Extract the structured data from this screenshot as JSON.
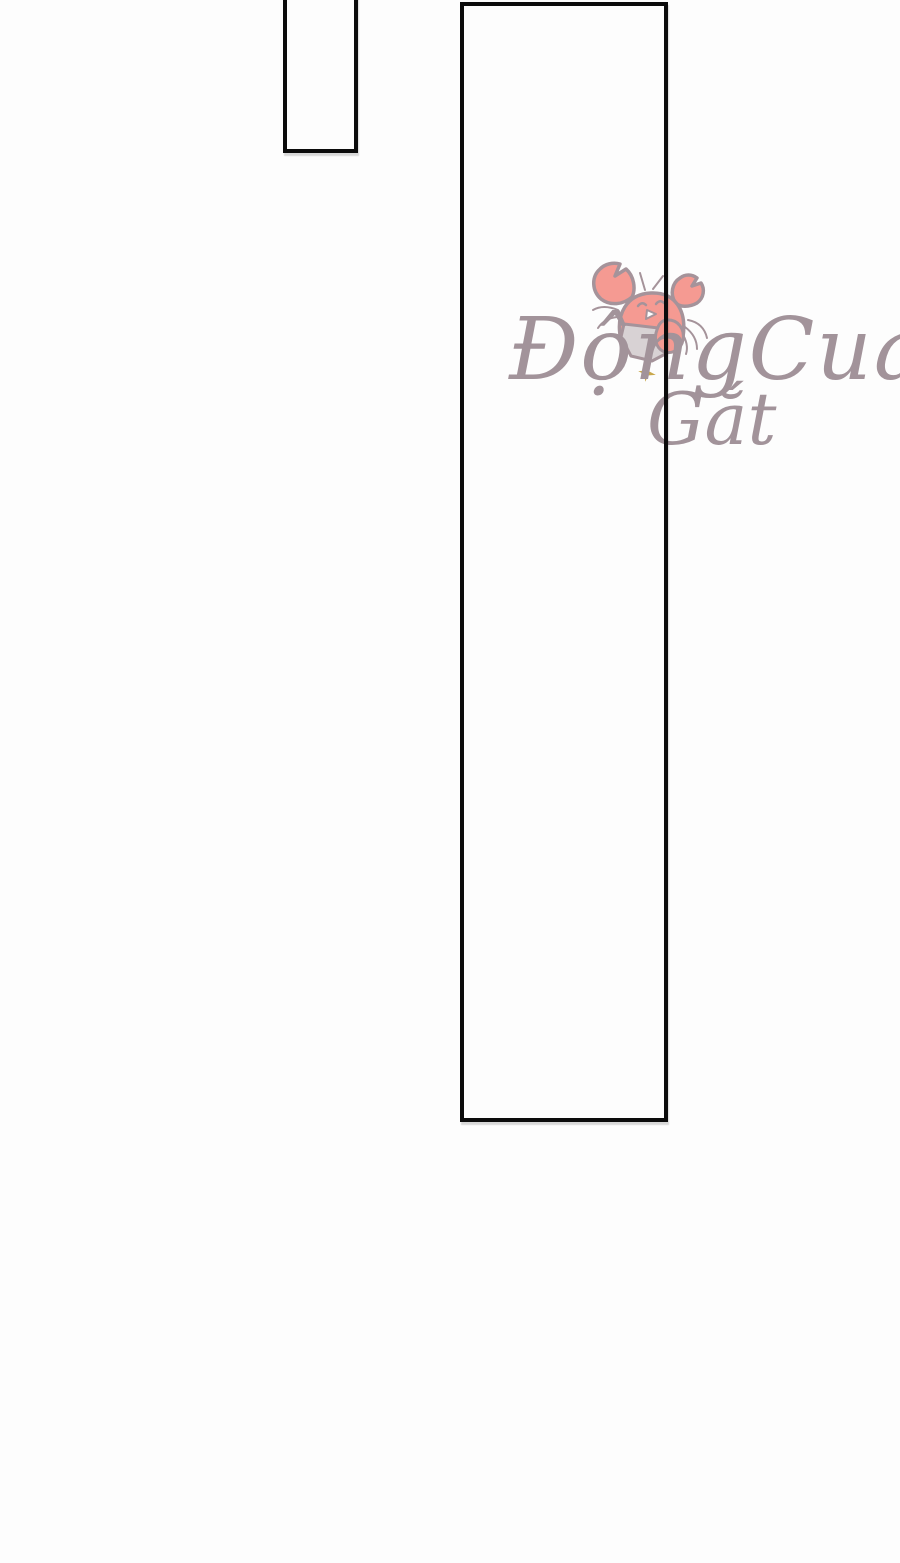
{
  "page": {
    "background_color": "#fdfdfd"
  },
  "panels": {
    "border_color": "#0b0b0b",
    "items": [
      {
        "name": "top-panel"
      },
      {
        "name": "main-panel"
      }
    ]
  },
  "watermark": {
    "line1": "ĐộngCua",
    "line2": "Gắt",
    "text_color": "#a2939a",
    "crab": {
      "body_color": "#f59a92",
      "outline_color": "#a5939a",
      "shell_color": "#d8d2d4",
      "mouth_color": "#ffffff",
      "sparkle_color": "#c9a84c"
    }
  }
}
